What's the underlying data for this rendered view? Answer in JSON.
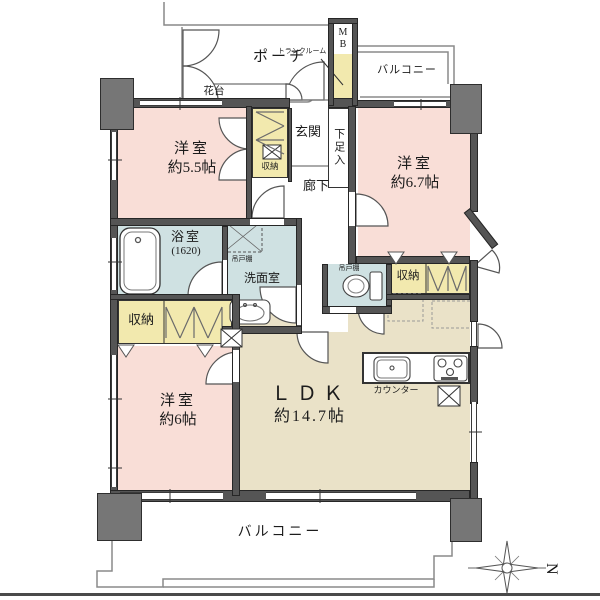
{
  "labels": {
    "bedroom1": {
      "name": "洋室",
      "size": "約5.5帖"
    },
    "bedroom2": {
      "name": "洋室",
      "size": "約6.7帖"
    },
    "bedroom3": {
      "name": "洋室",
      "size": "約6帖"
    },
    "ldk": {
      "name": "ＬＤＫ",
      "size": "約14.7帖"
    },
    "bath": {
      "name": "浴室",
      "size": "(1620)"
    },
    "washroom": "洗面室",
    "entrance": "玄関",
    "hallway": "廊下",
    "shoe_cabinet": "下足入",
    "porch": "ポーチ",
    "flower_stand": "花台",
    "trunk_room": "トランクルーム",
    "meter_box": {
      "l1": "M",
      "l2": "B"
    },
    "balcony": "バルコニー",
    "counter": "カウンター",
    "storage": "収納",
    "hanging_cabinet": "吊戸棚",
    "compass": "N"
  },
  "colors": {
    "room_pink": "#f9ded7",
    "ldk_tan": "#eae2c8",
    "wet_blue": "#cfe1e2",
    "closet_yellow": "#f2e9ae",
    "wall_gray": "#555555",
    "pillar_gray": "#767676"
  }
}
